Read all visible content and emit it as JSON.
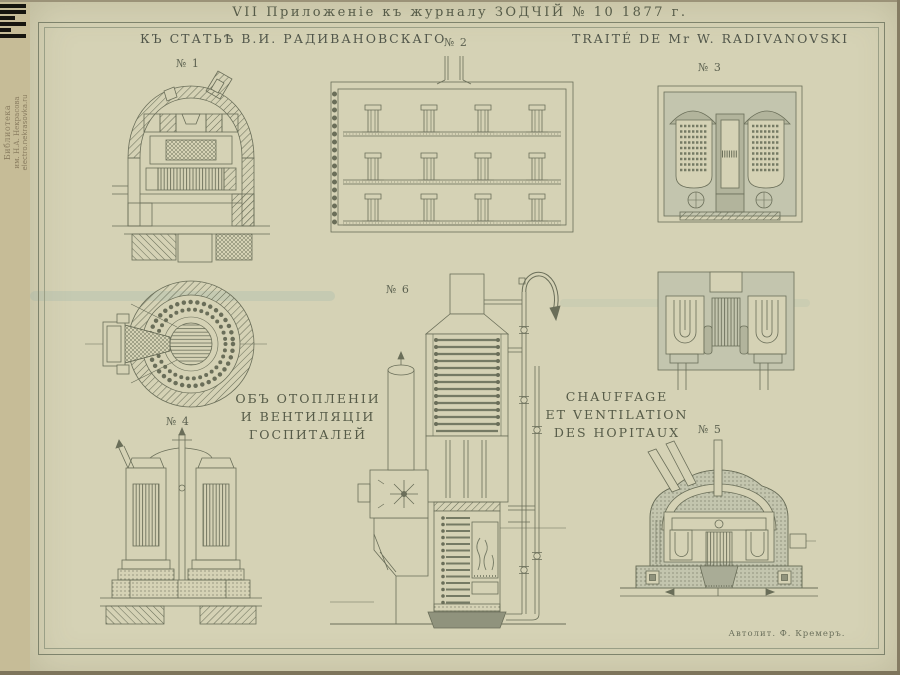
{
  "page": {
    "title": "VII Приложеніе къ журналу ЗОДЧІЙ № 10 1877 г.",
    "header_left": "КЪ СТАТЬѢ В.И. РАДИВАНОВСКАГО",
    "header_right": "TRAITÉ DE Mr W. RADIVANOVSKI",
    "signature": "Автолит. Ф. Кремеръ.",
    "colors": {
      "paper_margin": "#cdc6a3",
      "paper_plate": "#d5d2b5",
      "ink": "#5c614e",
      "masonry_grey": "#c3c5ae",
      "logo_black": "#16150f"
    }
  },
  "watermark": {
    "library_line1": "Библиотека",
    "library_line2": "им. Н.А. Некрасова",
    "site": "electro.nekrasovka.ru"
  },
  "captions": {
    "russian": [
      "ОБЪ ОТОПЛЕНІИ",
      "И ВЕНТИЛЯЦІИ",
      "ГОСПИТАЛЕЙ"
    ],
    "french": [
      "CHAUFFAGE",
      "ET VENTILATION",
      "DES HOPITAUX"
    ]
  },
  "figures": {
    "fig1": "№ 1",
    "fig2": "№ 2",
    "fig3": "№ 3",
    "fig4": "№ 4",
    "fig5": "№ 5",
    "fig6": "№ 6"
  }
}
